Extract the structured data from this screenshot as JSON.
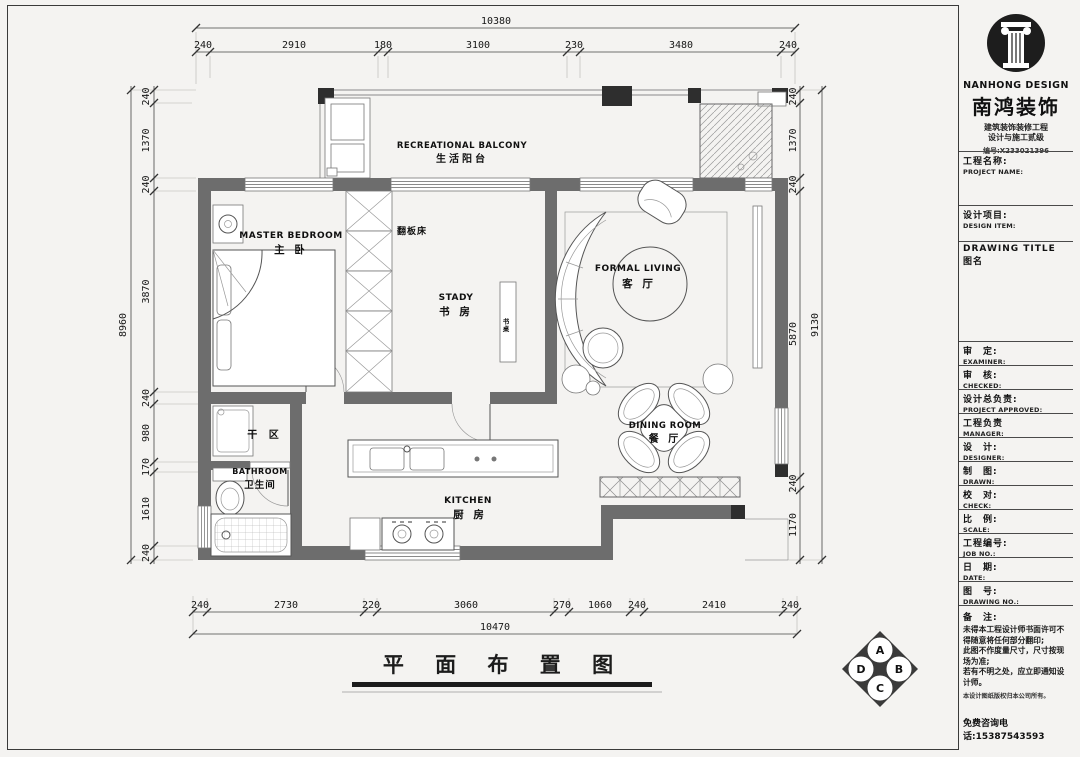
{
  "drawing": {
    "title": "平 面 布 置 图",
    "rooms": {
      "balcony": {
        "en": "RECREATIONAL BALCONY",
        "cn": "生活阳台"
      },
      "master": {
        "en": "MASTER BEDROOM",
        "cn": "主 卧"
      },
      "study": {
        "en": "STADY",
        "cn": "书 房"
      },
      "living": {
        "en": "FORMAL LIVING",
        "cn": "客 厅"
      },
      "dining": {
        "en": "DINING ROOM",
        "cn": "餐 厅"
      },
      "bathroom": {
        "en": "BATHROOM",
        "cn": "卫生间"
      },
      "kitchen": {
        "en": "KITCHEN",
        "cn": "厨 房"
      },
      "dry_area": {
        "cn": "干 区"
      },
      "wall_bed": {
        "cn": "翻板床"
      },
      "desk": {
        "cn": "书桌"
      }
    },
    "dimensions": {
      "top": {
        "total": "10380",
        "segments": [
          "240",
          "2910",
          "180",
          "3100",
          "230",
          "3480",
          "240"
        ]
      },
      "bottom": {
        "total": "10470",
        "segments": [
          "240",
          "2730",
          "220",
          "3060",
          "270",
          "1060",
          "240",
          "2410",
          "240"
        ]
      },
      "left": {
        "total": "8960",
        "segments": [
          "240",
          "1370",
          "240",
          "3870",
          "240",
          "980",
          "170",
          "1610",
          "240"
        ]
      },
      "right": {
        "total": "9130",
        "segments": [
          "240",
          "1370",
          "240",
          "5870",
          "240",
          "1170"
        ]
      }
    },
    "compass": {
      "top": "A",
      "right": "B",
      "bottom": "C",
      "left": "D"
    }
  },
  "titleblock": {
    "brand": {
      "en": "NANHONG DESIGN",
      "cn": "南鸿装饰",
      "cert1": "建筑装饰装修工程",
      "cert2": "设计与施工贰级",
      "cert_no": "编号:X233021396"
    },
    "rows": [
      {
        "cn": "工程名称:",
        "en": "PROJECT NAME:"
      },
      {
        "cn": "设计项目:",
        "en": "DESIGN ITEM:"
      },
      {
        "cn": "DRAWING TITLE 图名",
        "en": ""
      },
      {
        "cn": "审　定:",
        "en": "EXAMINER:"
      },
      {
        "cn": "审　核:",
        "en": "CHECKED:"
      },
      {
        "cn": "设计总负责:",
        "en": "PROJECT APPROVED:"
      },
      {
        "cn": "工程负责",
        "en": "MANAGER:"
      },
      {
        "cn": "设　计:",
        "en": "DESIGNER:"
      },
      {
        "cn": "制　图:",
        "en": "DRAWN:"
      },
      {
        "cn": "校　对:",
        "en": "CHECK:"
      },
      {
        "cn": "比　例:",
        "en": "SCALE:"
      },
      {
        "cn": "工程编号:",
        "en": "JOB NO.:"
      },
      {
        "cn": "日　期:",
        "en": "DATE:"
      },
      {
        "cn": "图　号:",
        "en": "DRAWING NO.:"
      }
    ],
    "notes": {
      "label": "备　注:",
      "lines": [
        "未得本工程设计师书面许可不得随意将任何部分翻印;",
        "此图不作度量尺寸，尺寸按现场为准;",
        "若有不明之处，应立即通知设计师。"
      ],
      "copyright": "本设计图纸版权归本公司所有。",
      "hotline": "免费咨询电话:15387543593"
    }
  },
  "colors": {
    "wall": "#6d6d6d",
    "column": "#2e2e2e",
    "line": "#3c3c3c",
    "paper": "#f4f3f1"
  }
}
